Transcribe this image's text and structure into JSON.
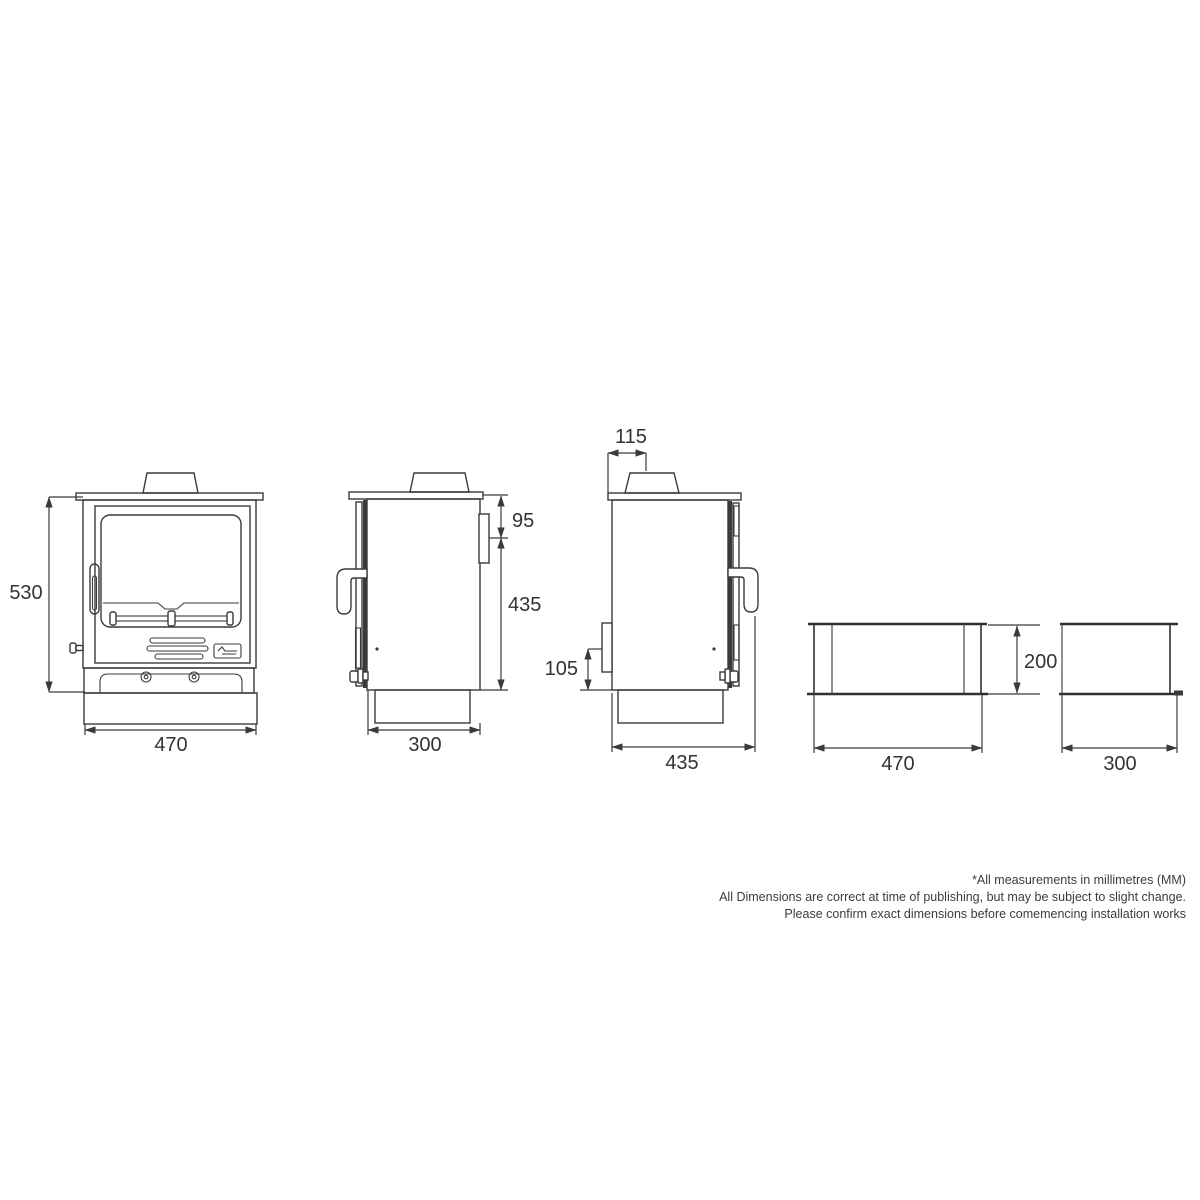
{
  "drawing": {
    "views": {
      "front": {
        "height": "530",
        "width": "470"
      },
      "side_left": {
        "flue_drop": "95",
        "body_height": "435",
        "depth": "300"
      },
      "side_right": {
        "flue_offset": "115",
        "outlet_height": "105",
        "overall_depth": "435"
      },
      "bench_front": {
        "height": "200",
        "width": "470"
      },
      "bench_side": {
        "depth": "300"
      }
    },
    "footnote": {
      "line1": "*All measurements in millimetres (MM)",
      "line2": "All Dimensions are correct at time of publishing, but may be subject to slight change.",
      "line3": "Please confirm exact dimensions before comemencing installation works"
    },
    "colors": {
      "line": "#3a3a3a",
      "text": "#333333",
      "background": "#ffffff"
    }
  }
}
